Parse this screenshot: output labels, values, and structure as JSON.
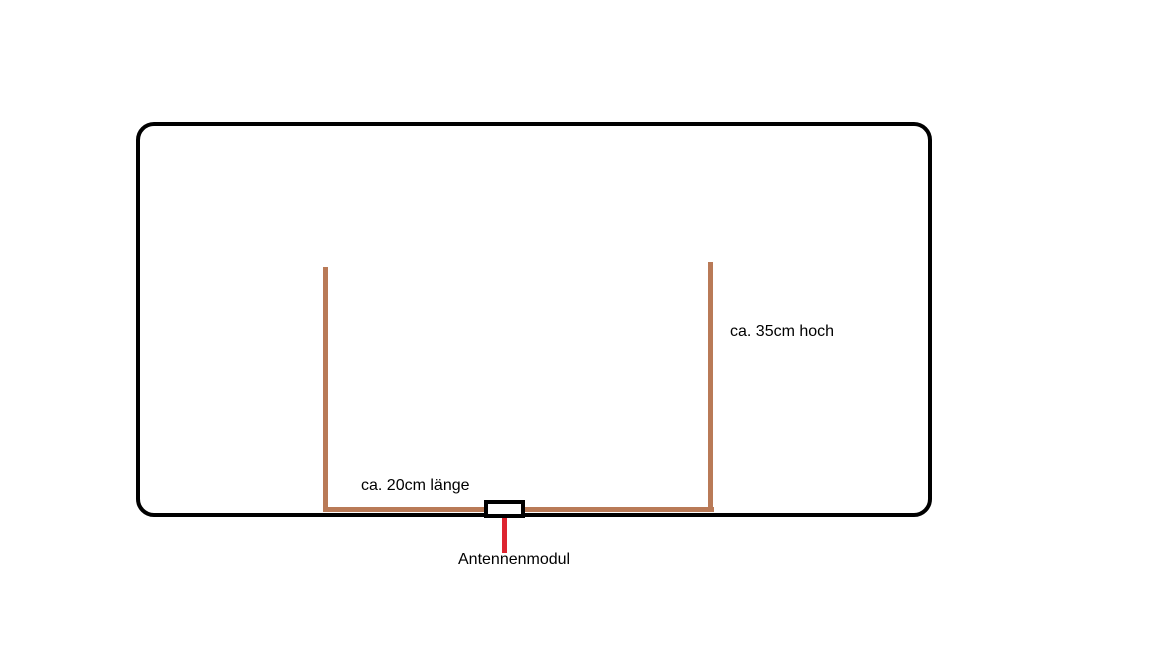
{
  "labels": {
    "height": "ca. 35cm hoch",
    "length": "ca. 20cm länge",
    "module": "Antennenmodul"
  },
  "colors": {
    "outline": "#000000",
    "wire": "#b97a57",
    "pointer": "#dd2430",
    "module_fill": "#ffffff",
    "text": "#000000",
    "background": "#ffffff"
  },
  "diagram": {
    "type": "sketch",
    "description_parts": {
      "enclosure": "rounded rectangle outline",
      "antenna_wire": "U-shaped wire, open at top",
      "module_box": "small rectangle on bottom wire",
      "pointer_line": "vertical line from module box to module label"
    }
  }
}
